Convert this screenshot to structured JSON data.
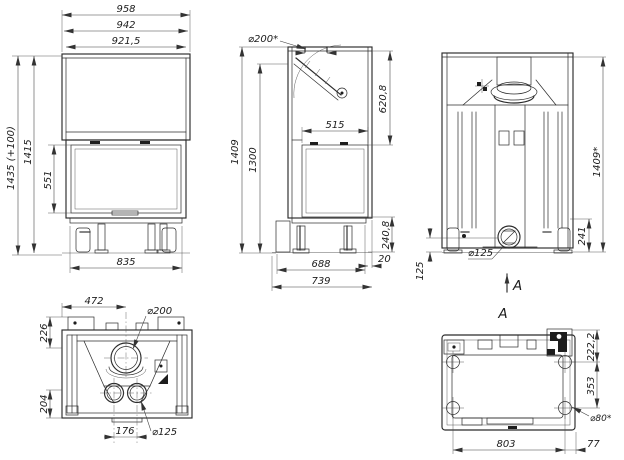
{
  "drawing": {
    "front_view": {
      "width_top": "958",
      "width_mid": "942",
      "width_inner": "921,5",
      "height_with_plinth": "1435 (+100)",
      "height_total": "1415",
      "glass_height": "551",
      "base_width": "835"
    },
    "side_view": {
      "flue_diameter": "⌀200*",
      "front_height": "620,8",
      "glass_width": "515",
      "height_total": "1409",
      "height_rear": "1300",
      "base_height": "240,8",
      "front_offset": "20",
      "base_depth": "688",
      "total_depth": "739"
    },
    "back_view": {
      "height_total": "1409*",
      "outlet_top_height": "241",
      "outlet_center_height": "125",
      "outlet_diameter": "⌀125",
      "view_arrow_label": "A"
    },
    "top_view": {
      "flue_center_offset": "472",
      "flue_diameter": "⌀200",
      "front_edge_offset": "226",
      "rear_edge_offset": "204",
      "outlet_spacing": "176",
      "outlet_diameter": "⌀125"
    },
    "bottom_view": {
      "section_label": "A",
      "hole_front_offset": "222,2",
      "hole_spacing_depth": "353",
      "hole_diameter": "⌀80*",
      "hole_spacing_width": "803",
      "hole_side_offset": "77"
    },
    "colors": {
      "line": "#2b2b2b",
      "dimension": "#3a3a3a",
      "background": "#ffffff"
    }
  }
}
